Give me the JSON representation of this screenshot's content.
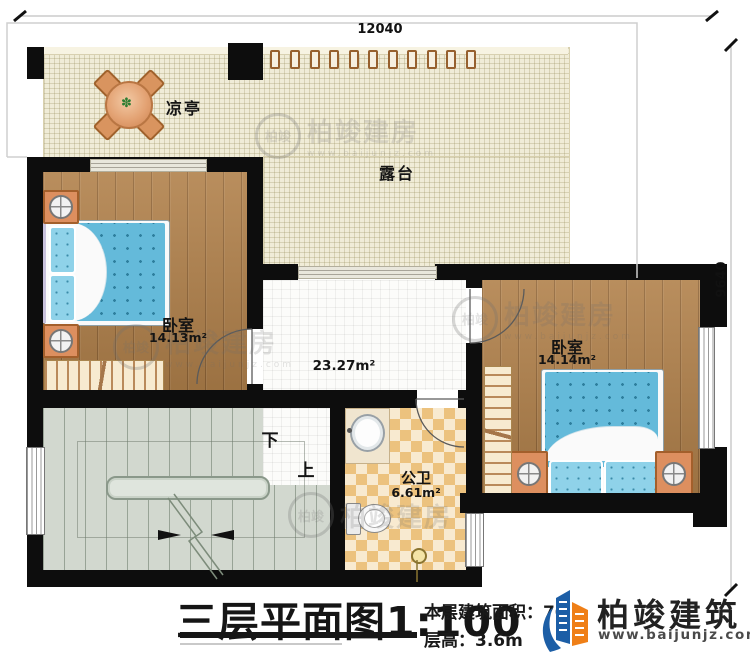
{
  "dimensions": {
    "top": "12040",
    "right": "9640"
  },
  "rooms": {
    "pavilion": {
      "label": "凉亭"
    },
    "terrace": {
      "label": "露台"
    },
    "bedroom_left": {
      "label": "卧室",
      "area": "14.13m²"
    },
    "bedroom_right": {
      "label": "卧室",
      "area": "14.14m²"
    },
    "hall": {
      "area": "23.27m²"
    },
    "bathroom": {
      "label": "公卫",
      "area": "6.61m²"
    },
    "stairs": {
      "down": "下",
      "up": "上"
    }
  },
  "title_block": {
    "title": "三层平面图1:100",
    "floor_area": "本层建筑面积：70",
    "floor_height": "层高：3.6m"
  },
  "brand": {
    "name": "柏竣建筑",
    "website": "www.baijunjz.com"
  },
  "watermark": {
    "text": "柏竣建房",
    "website": "www.baijunjz.com",
    "monogram": "柏竣"
  },
  "colors": {
    "wall": "#0d0d0d",
    "wood": "#b1814b",
    "terrace": "#f0ecd7",
    "bed": "#64bada",
    "checker": "#ecc27e",
    "stairs": "#d2d8cf",
    "brand_blue": "#1c5ea6",
    "brand_orange": "#ef7f17"
  }
}
